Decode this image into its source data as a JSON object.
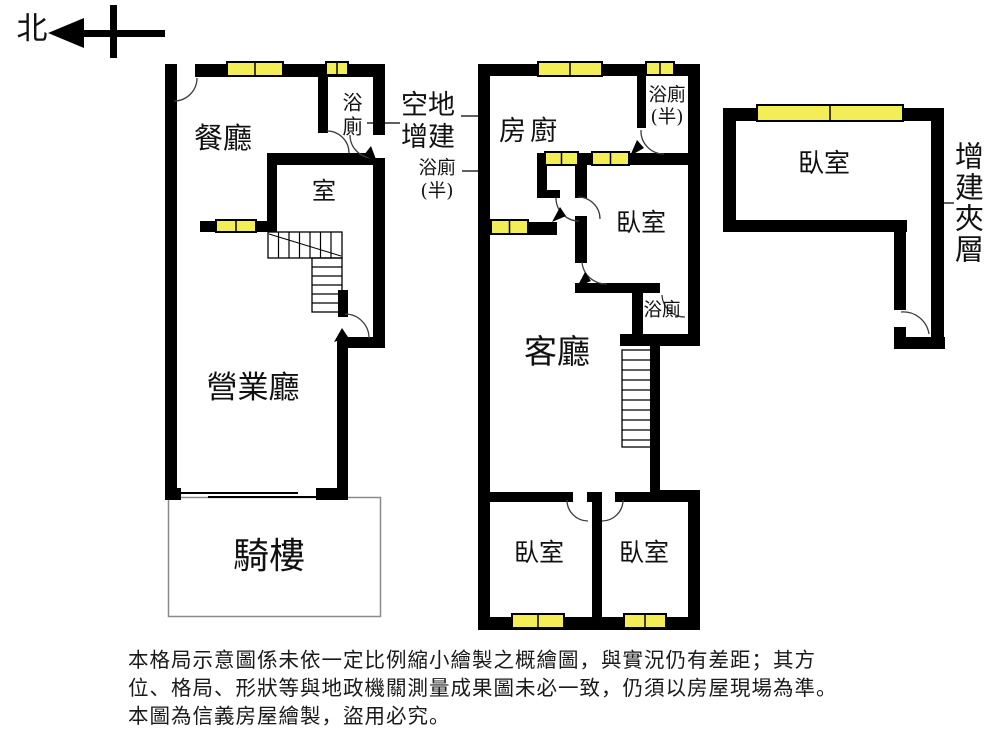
{
  "compass": {
    "north_label": "北"
  },
  "floor_ground": {
    "dining_room": "餐廳",
    "bathroom": "浴廁",
    "room": "室",
    "business_hall": "營業廳",
    "arcade": "騎樓"
  },
  "floor_upper": {
    "kitchen": "廚房",
    "half_bathroom": "浴廁\n(半)",
    "bedroom_top": "臥室",
    "bathroom": "浴廁",
    "living_room": "客廳",
    "bedroom_bottom_left": "臥室",
    "bedroom_bottom_right": "臥室"
  },
  "floor_mezzanine": {
    "bedroom": "臥室",
    "mezzanine_label": "增建夾層"
  },
  "annotations": {
    "vacant_addition": "空地\n增建",
    "half_bathroom_note": "浴廁\n(半)"
  },
  "disclaimer": {
    "line1": "本格局示意圖係未依一定比例縮小繪製之概繪圖，與實況仍有差距；其方",
    "line2": "位、格局、形狀等與地政機關測量成果圖未必一致，仍須以房屋現場為準。",
    "line3": "本圖為信義房屋繪製，盜用必究。"
  },
  "colors": {
    "wall": "#000000",
    "window_fill": "#f3ee55",
    "window_stroke": "#000000",
    "arc": "#3c3c3c",
    "arcade_outline": "#8a8a8a"
  }
}
